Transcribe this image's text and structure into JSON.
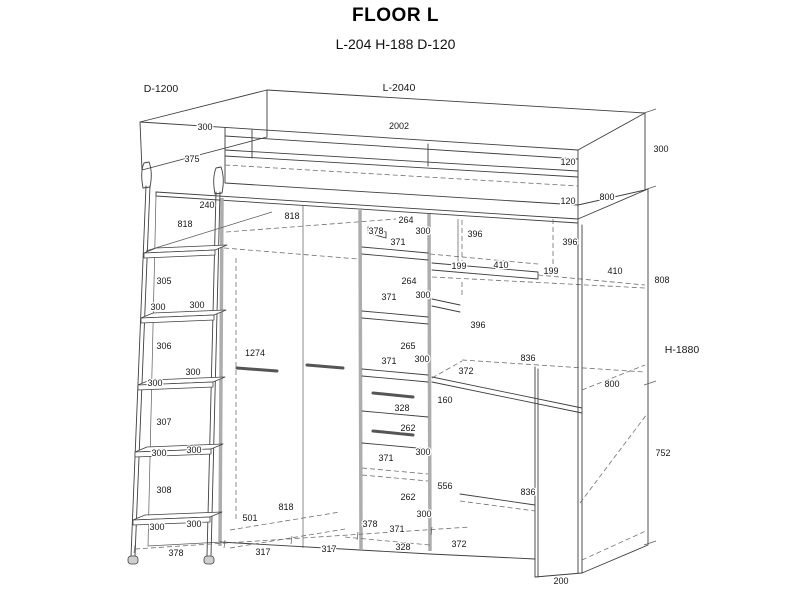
{
  "header": {
    "title": "FLOOR L",
    "subtitle": "L-204 H-188 D-120"
  },
  "diagram": {
    "labels": [
      {
        "t": "D-1200",
        "x": 161,
        "y": 89,
        "big": true
      },
      {
        "t": "L-2040",
        "x": 399,
        "y": 88,
        "big": true
      },
      {
        "t": "300",
        "x": 205,
        "y": 127
      },
      {
        "t": "2002",
        "x": 399,
        "y": 126
      },
      {
        "t": "300",
        "x": 661,
        "y": 149
      },
      {
        "t": "375",
        "x": 192,
        "y": 159
      },
      {
        "t": "120",
        "x": 568,
        "y": 162
      },
      {
        "t": "800",
        "x": 607,
        "y": 197
      },
      {
        "t": "120",
        "x": 568,
        "y": 201
      },
      {
        "t": "240",
        "x": 207,
        "y": 205
      },
      {
        "t": "818",
        "x": 185,
        "y": 224
      },
      {
        "t": "818",
        "x": 292,
        "y": 216
      },
      {
        "t": "264",
        "x": 406,
        "y": 220
      },
      {
        "t": "378",
        "x": 376,
        "y": 231
      },
      {
        "t": "300",
        "x": 423,
        "y": 231
      },
      {
        "t": "396",
        "x": 475,
        "y": 234
      },
      {
        "t": "371",
        "x": 398,
        "y": 242
      },
      {
        "t": "396",
        "x": 570,
        "y": 242
      },
      {
        "t": "199",
        "x": 459,
        "y": 266
      },
      {
        "t": "410",
        "x": 501,
        "y": 265
      },
      {
        "t": "199",
        "x": 551,
        "y": 271
      },
      {
        "t": "410",
        "x": 615,
        "y": 271
      },
      {
        "t": "808",
        "x": 662,
        "y": 280
      },
      {
        "t": "264",
        "x": 409,
        "y": 281
      },
      {
        "t": "305",
        "x": 164,
        "y": 281
      },
      {
        "t": "371",
        "x": 389,
        "y": 297
      },
      {
        "t": "300",
        "x": 423,
        "y": 295
      },
      {
        "t": "300",
        "x": 197,
        "y": 305
      },
      {
        "t": "300",
        "x": 158,
        "y": 307
      },
      {
        "t": "396",
        "x": 478,
        "y": 325
      },
      {
        "t": "306",
        "x": 164,
        "y": 346
      },
      {
        "t": "265",
        "x": 408,
        "y": 346
      },
      {
        "t": "1274",
        "x": 255,
        "y": 353
      },
      {
        "t": "H-1880",
        "x": 682,
        "y": 350,
        "big": true
      },
      {
        "t": "836",
        "x": 528,
        "y": 358
      },
      {
        "t": "300",
        "x": 422,
        "y": 359
      },
      {
        "t": "371",
        "x": 389,
        "y": 361
      },
      {
        "t": "372",
        "x": 466,
        "y": 371
      },
      {
        "t": "300",
        "x": 193,
        "y": 372
      },
      {
        "t": "300",
        "x": 155,
        "y": 383
      },
      {
        "t": "800",
        "x": 612,
        "y": 384
      },
      {
        "t": "160",
        "x": 445,
        "y": 400
      },
      {
        "t": "328",
        "x": 402,
        "y": 408
      },
      {
        "t": "307",
        "x": 164,
        "y": 422
      },
      {
        "t": "262",
        "x": 408,
        "y": 428
      },
      {
        "t": "300",
        "x": 194,
        "y": 450
      },
      {
        "t": "300",
        "x": 423,
        "y": 452
      },
      {
        "t": "300",
        "x": 159,
        "y": 453
      },
      {
        "t": "752",
        "x": 663,
        "y": 453
      },
      {
        "t": "371",
        "x": 386,
        "y": 458
      },
      {
        "t": "556",
        "x": 445,
        "y": 486
      },
      {
        "t": "308",
        "x": 164,
        "y": 490
      },
      {
        "t": "836",
        "x": 528,
        "y": 492
      },
      {
        "t": "262",
        "x": 408,
        "y": 497
      },
      {
        "t": "818",
        "x": 286,
        "y": 507
      },
      {
        "t": "300",
        "x": 424,
        "y": 514
      },
      {
        "t": "501",
        "x": 250,
        "y": 518
      },
      {
        "t": "378",
        "x": 370,
        "y": 524
      },
      {
        "t": "300",
        "x": 194,
        "y": 524
      },
      {
        "t": "300",
        "x": 157,
        "y": 527
      },
      {
        "t": "371",
        "x": 397,
        "y": 529
      },
      {
        "t": "372",
        "x": 459,
        "y": 544
      },
      {
        "t": "328",
        "x": 403,
        "y": 547
      },
      {
        "t": "317",
        "x": 329,
        "y": 549
      },
      {
        "t": "317",
        "x": 263,
        "y": 552
      },
      {
        "t": "378",
        "x": 176,
        "y": 553
      },
      {
        "t": "200",
        "x": 561,
        "y": 581
      }
    ]
  }
}
